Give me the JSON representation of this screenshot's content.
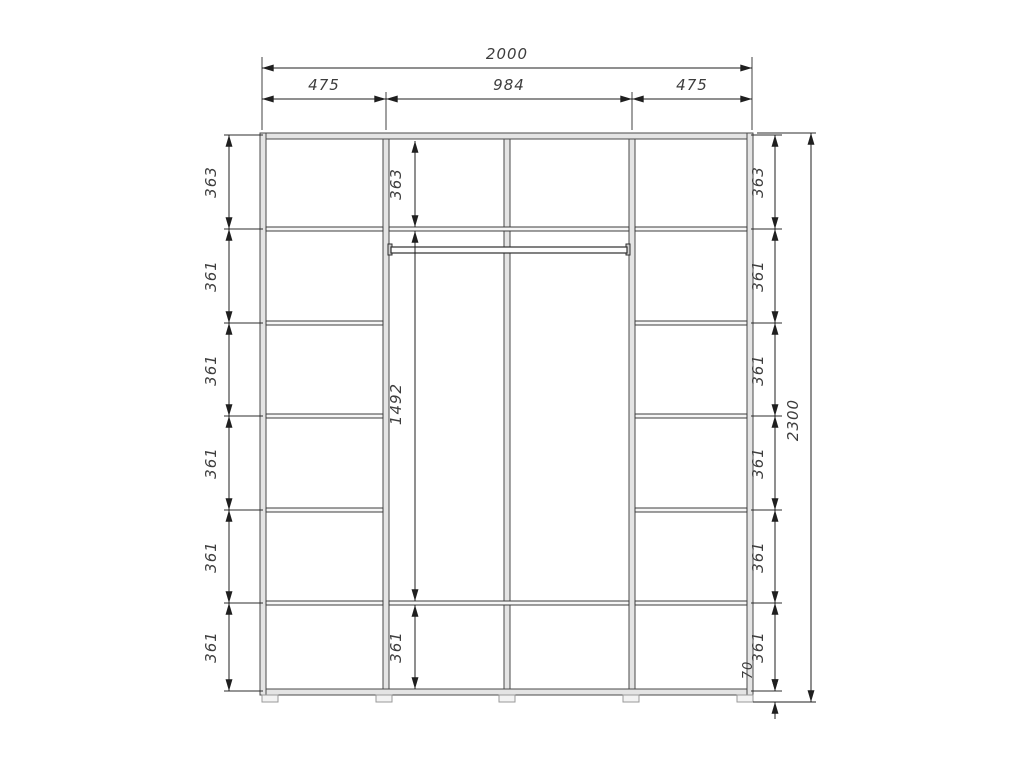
{
  "width_dims": {
    "overall": "2000",
    "left_section": "475",
    "center_section": "984",
    "right_section": "475"
  },
  "left_heights": [
    "363",
    "361",
    "361",
    "361",
    "361",
    "361"
  ],
  "center_heights": {
    "top": "363",
    "middle": "1492",
    "bottom": "361"
  },
  "right_heights": [
    "363",
    "361",
    "361",
    "361",
    "361",
    "361"
  ],
  "overall_height": "2300",
  "base_height": "70",
  "colors": {
    "line": "#1f1f1f",
    "panel_fill": "#e4e4e4",
    "dim_text": "#3d3d3d",
    "background": "#ffffff"
  }
}
